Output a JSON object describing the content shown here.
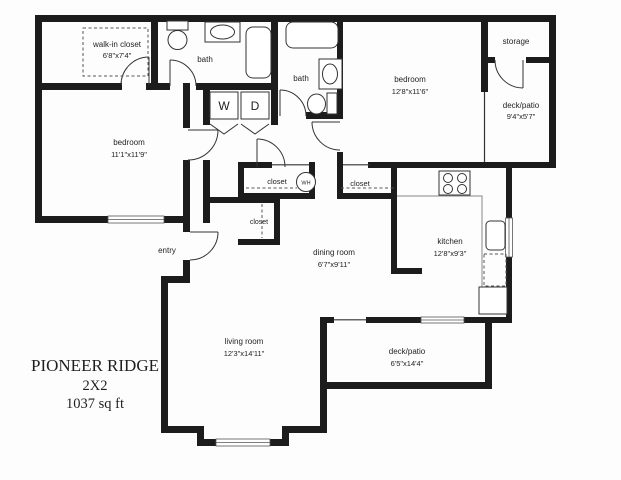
{
  "plan": {
    "title": "PIONEER RIDGE",
    "unit": "2X2",
    "area": "1037 sq ft",
    "rooms": {
      "walk_in_closet": {
        "name": "walk-in closet",
        "dims": "6'8\"x7'4\""
      },
      "bath_1": {
        "name": "bath"
      },
      "bath_2": {
        "name": "bath"
      },
      "bedroom_1": {
        "name": "bedroom",
        "dims": "11'1\"x11'9\""
      },
      "bedroom_2": {
        "name": "bedroom",
        "dims": "12'8\"x11'6\""
      },
      "storage": {
        "name": "storage"
      },
      "deck_patio_upper": {
        "name": "deck/patio",
        "dims": "9'4\"x5'7\""
      },
      "deck_patio_lower": {
        "name": "deck/patio",
        "dims": "6'5\"x14'4\""
      },
      "kitchen": {
        "name": "kitchen",
        "dims": "12'8\"x9'3\""
      },
      "dining_room": {
        "name": "dining room",
        "dims": "6'7\"x9'11\""
      },
      "living_room": {
        "name": "living room",
        "dims": "12'3\"x14'11\""
      },
      "entry": {
        "name": "entry"
      },
      "hall_closet_1": {
        "name": "closet"
      },
      "hall_closet_2": {
        "name": "closet"
      },
      "entry_closet": {
        "name": "closet"
      }
    },
    "appliances": {
      "washer": "W",
      "dryer": "D",
      "water_heater": "WH"
    }
  }
}
